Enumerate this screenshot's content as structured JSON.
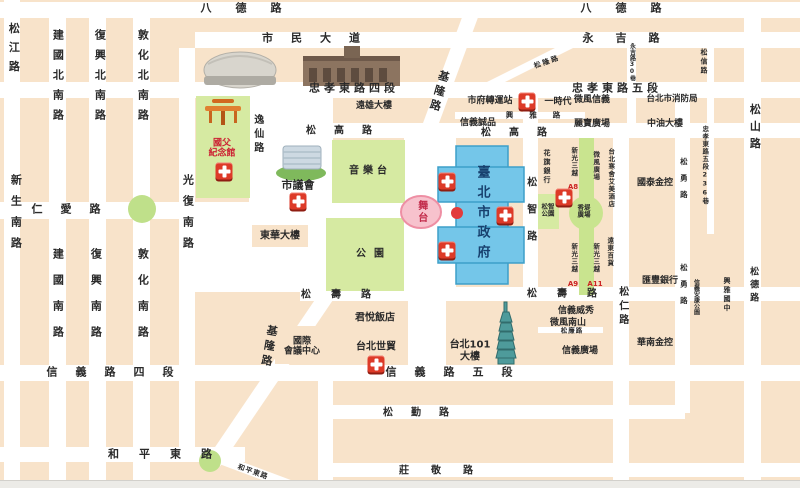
{
  "map": {
    "colors": {
      "block_peach": "#f8e3ca",
      "road_white": "#ffffff",
      "park_green": "#d6eaa2",
      "promenade_green": "#c9e48f",
      "city_hall_blue": "#74c6e9",
      "stage_pink": "#f7c2cd",
      "first_aid_red": "#dd3a28",
      "accent_red_text": "#cc2233",
      "city_hall_text": "#17406e"
    },
    "road_labels": [
      {
        "id": "road-bade-w",
        "text": "八德路",
        "x": 253,
        "y": 9,
        "dir": "h",
        "size": 11,
        "ls": 24
      },
      {
        "id": "road-bade-e",
        "text": "八德路",
        "x": 633,
        "y": 9,
        "dir": "h",
        "size": 11,
        "ls": 24
      },
      {
        "id": "road-civic-blvd",
        "text": "市民大道",
        "x": 320,
        "y": 39,
        "dir": "h",
        "size": 11,
        "ls": 18
      },
      {
        "id": "road-yongji",
        "text": "永吉路",
        "x": 632,
        "y": 39,
        "dir": "h",
        "size": 11,
        "ls": 22
      },
      {
        "id": "road-zhongxiao-e-4",
        "text": "忠孝東路四段",
        "x": 354,
        "y": 89,
        "dir": "h",
        "size": 11,
        "ls": 4
      },
      {
        "id": "road-zhongxiao-e-5",
        "text": "忠孝東路五段",
        "x": 617,
        "y": 89,
        "dir": "h",
        "size": 11,
        "ls": 4
      },
      {
        "id": "road-songgao-w",
        "text": "松高路",
        "x": 348,
        "y": 131,
        "dir": "h",
        "size": 10,
        "ls": 18
      },
      {
        "id": "road-songgao-e",
        "text": "松高路",
        "x": 523,
        "y": 133,
        "dir": "h",
        "size": 10,
        "ls": 18
      },
      {
        "id": "road-renai",
        "text": "仁愛路",
        "x": 75,
        "y": 210,
        "dir": "h",
        "size": 11,
        "ls": 18
      },
      {
        "id": "road-xinyi-4",
        "text": "信義路四段",
        "x": 119,
        "y": 373,
        "dir": "h",
        "size": 11,
        "ls": 18
      },
      {
        "id": "road-xinyi-5",
        "text": "信義路五段",
        "x": 458,
        "y": 373,
        "dir": "h",
        "size": 11,
        "ls": 18
      },
      {
        "id": "road-songshou-w",
        "text": "松壽路",
        "x": 346,
        "y": 295,
        "dir": "h",
        "size": 10,
        "ls": 20
      },
      {
        "id": "road-songshou-e",
        "text": "松壽路",
        "x": 572,
        "y": 294,
        "dir": "h",
        "size": 10,
        "ls": 20
      },
      {
        "id": "road-songqin",
        "text": "松勤路",
        "x": 425,
        "y": 413,
        "dir": "h",
        "size": 10,
        "ls": 18
      },
      {
        "id": "road-zhuangjing",
        "text": "莊敬路",
        "x": 447,
        "y": 471,
        "dir": "h",
        "size": 10,
        "ls": 22
      },
      {
        "id": "road-heping-e",
        "text": "和平東路",
        "x": 170,
        "y": 455,
        "dir": "h",
        "size": 11,
        "ls": 20
      },
      {
        "id": "road-xingya",
        "text": "興雅路",
        "x": 541,
        "y": 116,
        "dir": "h",
        "size": 7.5,
        "ls": 16
      },
      {
        "id": "road-songlian",
        "text": "松廉路",
        "x": 572,
        "y": 331,
        "dir": "h",
        "size": 6.5,
        "ls": 1
      },
      {
        "id": "road-songjiang",
        "text": "松江路",
        "x": 13,
        "y": 51,
        "dir": "v",
        "size": 11,
        "ls": 8
      },
      {
        "id": "road-xinsheng-s",
        "text": "新生南路",
        "x": 15,
        "y": 216,
        "dir": "v",
        "size": 11,
        "ls": 10
      },
      {
        "id": "road-jianguo-n",
        "text": "建國北南路",
        "x": 57,
        "y": 79,
        "dir": "v",
        "size": 11,
        "ls": 9
      },
      {
        "id": "road-fuxing-n",
        "text": "復興北南路",
        "x": 99,
        "y": 79,
        "dir": "v",
        "size": 11,
        "ls": 9
      },
      {
        "id": "road-dunhua-n",
        "text": "敦化北南路",
        "x": 142,
        "y": 79,
        "dir": "v",
        "size": 11,
        "ls": 9
      },
      {
        "id": "road-jianguo-s",
        "text": "建國南路",
        "x": 57,
        "y": 300,
        "dir": "v",
        "size": 11,
        "ls": 15
      },
      {
        "id": "road-fuxing-s",
        "text": "復興南路",
        "x": 95,
        "y": 300,
        "dir": "v",
        "size": 11,
        "ls": 15
      },
      {
        "id": "road-dunhua-s",
        "text": "敦化南路",
        "x": 142,
        "y": 300,
        "dir": "v",
        "size": 11,
        "ls": 15
      },
      {
        "id": "road-guangfu-s",
        "text": "光復南路",
        "x": 187,
        "y": 216,
        "dir": "v",
        "size": 11,
        "ls": 10
      },
      {
        "id": "road-yixian",
        "text": "逸仙路",
        "x": 257,
        "y": 135,
        "dir": "v",
        "size": 10,
        "ls": 4
      },
      {
        "id": "road-songzhi",
        "text": "松智路",
        "x": 530,
        "y": 217,
        "dir": "v",
        "size": 10,
        "ls": 17
      },
      {
        "id": "road-songren",
        "text": "松仁路",
        "x": 622,
        "y": 307,
        "dir": "v",
        "size": 10,
        "ls": 4
      },
      {
        "id": "road-songyong-n",
        "text": "松勇路",
        "x": 683,
        "y": 182,
        "dir": "v",
        "size": 7.5,
        "ls": 9
      },
      {
        "id": "road-songyong-s",
        "text": "松勇路",
        "x": 683,
        "y": 288,
        "dir": "v",
        "size": 7.5,
        "ls": 9
      },
      {
        "id": "road-songshan",
        "text": "松山路",
        "x": 754,
        "y": 129,
        "dir": "v",
        "size": 11,
        "ls": 6
      },
      {
        "id": "road-songde",
        "text": "松德路",
        "x": 753,
        "y": 286,
        "dir": "v",
        "size": 9,
        "ls": 4
      },
      {
        "id": "road-songxin",
        "text": "松信路",
        "x": 704,
        "y": 62,
        "dir": "v",
        "size": 7,
        "ls": 2
      },
      {
        "id": "road-zhongxiao-236-lane",
        "text": "忠孝東路五段236巷",
        "x": 704,
        "y": 165,
        "dir": "v",
        "size": 6.5,
        "ls": 1
      },
      {
        "id": "road-yongji-lane-30",
        "text": "永吉路30巷",
        "x": 631,
        "y": 62,
        "dir": "v",
        "size": 6,
        "ls": 0
      },
      {
        "id": "road-keelung-n",
        "text": "基隆路",
        "x": 438,
        "y": 92,
        "dir": "v",
        "size": 11,
        "ls": 4,
        "rot": 16
      },
      {
        "id": "road-keelung-s",
        "text": "基隆路",
        "x": 268,
        "y": 347,
        "dir": "v",
        "size": 11,
        "ls": 4,
        "rot": 10
      },
      {
        "id": "road-songlong",
        "text": "松隆路",
        "x": 547,
        "y": 62,
        "dir": "h",
        "size": 7,
        "ls": 2,
        "rot": -19
      },
      {
        "id": "road-heping-e-diag",
        "text": "和平東路",
        "x": 253,
        "y": 472,
        "dir": "h",
        "size": 7,
        "ls": 1,
        "rot": 19
      }
    ],
    "place_labels": [
      {
        "id": "place-farglory-bldg",
        "text": "遠雄大樓",
        "x": 374,
        "y": 106,
        "dir": "h",
        "size": 9
      },
      {
        "id": "place-city-hall-bus-station",
        "text": "市府轉運站",
        "x": 490,
        "y": 101,
        "dir": "h",
        "size": 9
      },
      {
        "id": "place-uni-ustyle",
        "text": "一時代",
        "x": 558,
        "y": 102,
        "dir": "h",
        "size": 9
      },
      {
        "id": "place-breeze-xinyi",
        "text": "微風信義",
        "x": 592,
        "y": 100,
        "dir": "h",
        "size": 9
      },
      {
        "id": "place-fire-dept",
        "text": "台北市消防局",
        "x": 672,
        "y": 100,
        "dir": "h",
        "size": 8.5
      },
      {
        "id": "place-eslite-xinyi",
        "text": "信義誠品",
        "x": 478,
        "y": 123,
        "dir": "h",
        "size": 9
      },
      {
        "id": "place-libao-plaza",
        "text": "麗寶廣場",
        "x": 592,
        "y": 124,
        "dir": "h",
        "size": 9
      },
      {
        "id": "place-cpc-bldg",
        "text": "中油大樓",
        "x": 665,
        "y": 124,
        "dir": "h",
        "size": 9
      },
      {
        "id": "place-cathay-financial",
        "text": "國泰金控",
        "x": 655,
        "y": 183,
        "dir": "h",
        "size": 9
      },
      {
        "id": "place-hsbc",
        "text": "匯豐銀行",
        "x": 660,
        "y": 281,
        "dir": "h",
        "size": 9
      },
      {
        "id": "place-huanan-financial",
        "text": "華南金控",
        "x": 655,
        "y": 343,
        "dir": "h",
        "size": 9
      },
      {
        "id": "place-vieshow",
        "text": "信義威秀",
        "x": 576,
        "y": 311,
        "dir": "h",
        "size": 9
      },
      {
        "id": "place-breeze-nanshan",
        "text": "微風南山",
        "x": 568,
        "y": 323,
        "dir": "h",
        "size": 9
      },
      {
        "id": "place-xinyi-plaza",
        "text": "信義廣場",
        "x": 580,
        "y": 351,
        "dir": "h",
        "size": 9
      },
      {
        "id": "place-grand-hyatt",
        "text": "君悅飯店",
        "x": 375,
        "y": 318,
        "dir": "h",
        "size": 10
      },
      {
        "id": "place-twtc",
        "text": "台北世貿",
        "x": 376,
        "y": 347,
        "dir": "h",
        "size": 10
      },
      {
        "id": "place-ticc",
        "lines": [
          "國際",
          "會議中心"
        ],
        "x": 302,
        "y": 347,
        "dir": "h",
        "size": 9
      },
      {
        "id": "place-taipei-101",
        "lines": [
          "台北101",
          "大樓"
        ],
        "x": 470,
        "y": 351,
        "dir": "h",
        "size": 10
      },
      {
        "id": "place-donghua-bldg",
        "text": "東華大樓",
        "x": 280,
        "y": 236,
        "dir": "h",
        "size": 10
      },
      {
        "id": "place-park",
        "text": "公園",
        "x": 374,
        "y": 254,
        "dir": "h",
        "size": 10,
        "ls": 8
      },
      {
        "id": "place-music-stage",
        "text": "音樂台",
        "x": 370,
        "y": 171,
        "dir": "h",
        "size": 10,
        "ls": 4
      },
      {
        "id": "place-city-council",
        "text": "市議會",
        "x": 298,
        "y": 186,
        "dir": "h",
        "size": 11
      },
      {
        "id": "place-sys-memorial",
        "lines": [
          "國父",
          "紀念館"
        ],
        "x": 222,
        "y": 149,
        "dir": "h",
        "size": 9,
        "color": "#cc2233"
      },
      {
        "id": "place-stage",
        "text": "舞台",
        "x": 421,
        "y": 212,
        "dir": "v",
        "size": 10,
        "ls": 2,
        "color": "#c22b4a"
      },
      {
        "id": "place-taipei-city-hall",
        "text": "臺北市政府",
        "x": 481,
        "y": 215,
        "dir": "v",
        "size": 13,
        "ls": 7,
        "color": "#17406e"
      },
      {
        "id": "place-citibank",
        "text": "花旗銀行",
        "x": 547,
        "y": 167,
        "dir": "v",
        "size": 7,
        "ls": 2
      },
      {
        "id": "place-skm-a8",
        "text": "新光三越",
        "x": 573,
        "y": 162,
        "dir": "v",
        "size": 6.5,
        "ls": 1
      },
      {
        "id": "place-skm-a8-tag",
        "text": "A8",
        "x": 573,
        "y": 187,
        "dir": "h",
        "size": 7,
        "color": "#cc2222"
      },
      {
        "id": "place-breeze-square",
        "text": "微風廣場",
        "x": 595,
        "y": 166,
        "dir": "v",
        "size": 6.5,
        "ls": 1
      },
      {
        "id": "place-le-meridien",
        "text": "台北寒舍艾美酒店",
        "x": 610,
        "y": 178,
        "dir": "v",
        "size": 6.5,
        "ls": 1
      },
      {
        "id": "place-shianti-plaza",
        "lines": [
          "香堤",
          "廣場"
        ],
        "x": 584,
        "y": 212,
        "dir": "h",
        "size": 6.5
      },
      {
        "id": "place-songzhi-park",
        "lines": [
          "松智",
          "公園"
        ],
        "x": 548,
        "y": 211,
        "dir": "h",
        "size": 6.5
      },
      {
        "id": "place-skm-a9",
        "text": "新光三越",
        "x": 573,
        "y": 258,
        "dir": "v",
        "size": 6.5,
        "ls": 1
      },
      {
        "id": "place-skm-a9-tag",
        "text": "A9",
        "x": 573,
        "y": 284,
        "dir": "h",
        "size": 7,
        "color": "#cc2222"
      },
      {
        "id": "place-skm-a11",
        "text": "新光三越",
        "x": 595,
        "y": 258,
        "dir": "v",
        "size": 6.5,
        "ls": 1
      },
      {
        "id": "place-skm-a11-tag",
        "text": "A11",
        "x": 595,
        "y": 284,
        "dir": "h",
        "size": 7,
        "color": "#cc2222"
      },
      {
        "id": "place-feds-dept",
        "text": "遠東百貨",
        "x": 609,
        "y": 252,
        "dir": "v",
        "size": 6.5,
        "ls": 1
      },
      {
        "id": "place-xingya-junior-high",
        "text": "興雅國中",
        "x": 727,
        "y": 295,
        "dir": "v",
        "size": 7,
        "ls": 2
      },
      {
        "id": "place-ankang-park",
        "text": "信義安康公園",
        "x": 695,
        "y": 297,
        "dir": "v",
        "size": 6,
        "ls": 0
      }
    ],
    "aid_stations": [
      {
        "x": 527,
        "y": 101
      },
      {
        "x": 224,
        "y": 171
      },
      {
        "x": 298,
        "y": 201
      },
      {
        "x": 447,
        "y": 181
      },
      {
        "x": 505,
        "y": 215
      },
      {
        "x": 447,
        "y": 250
      },
      {
        "x": 564,
        "y": 197
      },
      {
        "x": 376,
        "y": 364
      }
    ]
  }
}
